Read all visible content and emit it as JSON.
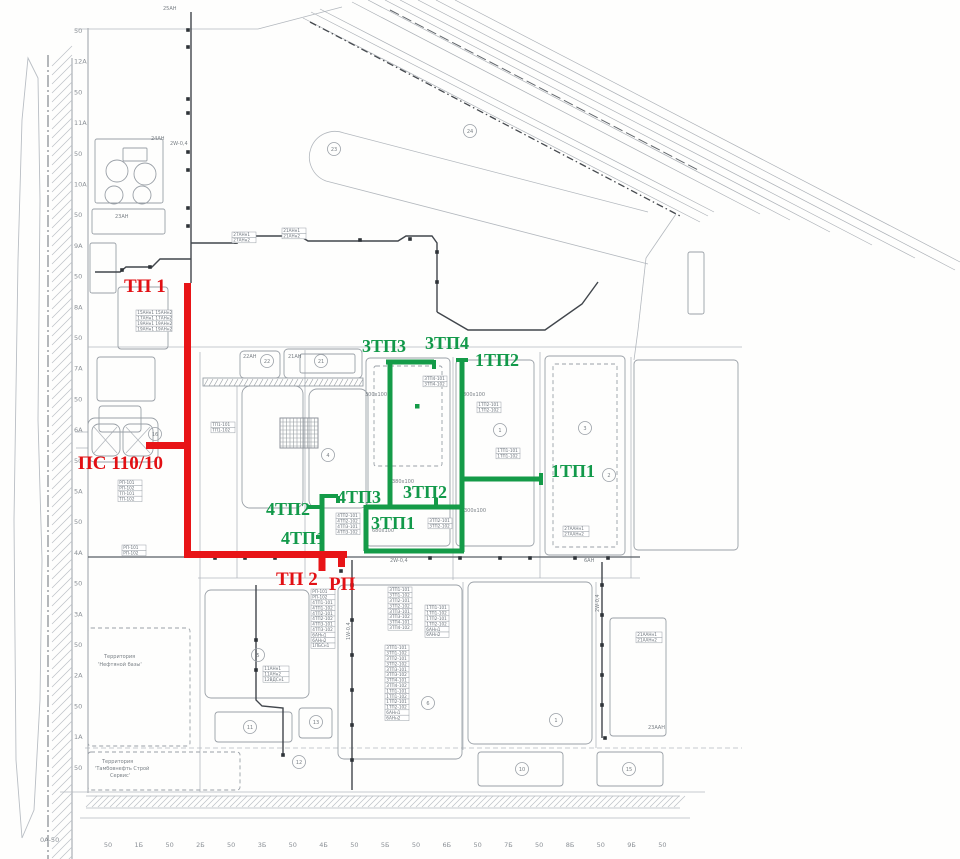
{
  "red_network": {
    "color": "#e81417",
    "labels": [
      {
        "text": "ТП 1"
      },
      {
        "text": "ПС 110/10"
      },
      {
        "text": "ТП 2"
      },
      {
        "text": "РП"
      }
    ]
  },
  "green_network": {
    "color": "#149b48",
    "labels": [
      {
        "text": "3ТП3"
      },
      {
        "text": "3ТП4"
      },
      {
        "text": "1ТП2"
      },
      {
        "text": "1ТП1"
      },
      {
        "text": "3ТП2"
      },
      {
        "text": "3ТП1"
      },
      {
        "text": "4ТП3"
      },
      {
        "text": "4ТП2"
      },
      {
        "text": "4ТП1"
      }
    ]
  },
  "axes": {
    "left": [
      "50",
      "12А",
      "50",
      "11А",
      "50",
      "10А",
      "50",
      "9А",
      "50",
      "8А",
      "50",
      "7А",
      "50",
      "6А",
      "50",
      "5А",
      "50",
      "4А",
      "50",
      "3А",
      "50",
      "2А",
      "50",
      "1А",
      "50"
    ],
    "origin": "0А-50",
    "bottom": [
      "50",
      "1Б",
      "50",
      "2Б",
      "50",
      "3Б",
      "50",
      "4Б",
      "50",
      "5Б",
      "50",
      "6Б",
      "50",
      "7Б",
      "50",
      "8Б",
      "50",
      "9Б",
      "50"
    ]
  },
  "annotations": {
    "boxes": [
      {
        "x": 311,
        "y": 589,
        "w": 24,
        "rows": [
          "РП-101",
          "РП-102",
          "4ТП1-101",
          "4ТП1-102",
          "4ТП2-101",
          "4ТП2-102",
          "4ТП3-101",
          "4ТП3-102",
          "6АНн1",
          "6АНн2",
          "1ПБСн1"
        ]
      },
      {
        "x": 388,
        "y": 587,
        "w": 24,
        "rows": [
          "3ТП1-101",
          "3ТП1-102",
          "3ТП2-101",
          "3ТП2-102",
          "3ТП3-101",
          "3ТП3-102",
          "3ТП4-101",
          "3ТП4-102"
        ]
      },
      {
        "x": 425,
        "y": 605,
        "w": 24,
        "rows": [
          "1ТП1-101",
          "1ТП1-102",
          "1ТП2-101",
          "1ТП2-102",
          "6АНн1",
          "6АНн2"
        ]
      },
      {
        "x": 385,
        "y": 645,
        "w": 24,
        "rows": [
          "3ТП1-101",
          "3ТП1-102",
          "3ТП2-101",
          "3ТП2-102",
          "3ТП3-101",
          "3ТП3-102",
          "3ТП4-101",
          "3ТП4-102",
          "1ТП1-101",
          "1ТП1-102",
          "1ТП2-101",
          "1ТП2-102",
          "6АНн1",
          "6АНн2"
        ]
      },
      {
        "x": 118,
        "y": 480,
        "w": 24,
        "rows": [
          "РП-101",
          "РП-102",
          "ТП-101",
          "ТП-102"
        ]
      },
      {
        "x": 122,
        "y": 545,
        "w": 24,
        "rows": [
          "РП-101",
          "РП-102"
        ]
      },
      {
        "x": 136,
        "y": 310,
        "w": 36,
        "rows": [
          "15АНн1 15АНн2",
          "17АНн1 17АНн2",
          "19АНн1 19АНн2",
          "19АНн1 19АНн2"
        ]
      },
      {
        "x": 211,
        "y": 422,
        "w": 24,
        "rows": [
          "ТП1-101",
          "ТП1-102"
        ]
      },
      {
        "x": 477,
        "y": 402,
        "w": 24,
        "rows": [
          "1ТП2-101",
          "1ТП2-102"
        ]
      },
      {
        "x": 423,
        "y": 376,
        "w": 24,
        "rows": [
          "3ТП4-101",
          "3ТП4-102"
        ]
      },
      {
        "x": 496,
        "y": 448,
        "w": 24,
        "rows": [
          "1ТП1-101",
          "1ТП1-102"
        ]
      },
      {
        "x": 428,
        "y": 518,
        "w": 24,
        "rows": [
          "3ТП2-101",
          "3ТП2-102"
        ]
      },
      {
        "x": 336,
        "y": 513,
        "w": 24,
        "rows": [
          "4ТП2-101",
          "4ТП2-102",
          "4ТП3-101",
          "4ТП3-102"
        ]
      },
      {
        "x": 563,
        "y": 526,
        "w": 26,
        "rows": [
          "27ААНн1",
          "27ААНн2"
        ]
      },
      {
        "x": 636,
        "y": 632,
        "w": 26,
        "rows": [
          "21ААНн1",
          "21ААНн2"
        ]
      },
      {
        "x": 263,
        "y": 666,
        "w": 26,
        "rows": [
          "11АНн1",
          "11АНн2",
          "12ВДСн1"
        ]
      },
      {
        "x": 282,
        "y": 228,
        "w": 24,
        "rows": [
          "21АНн1",
          "21АНн2"
        ]
      },
      {
        "x": 232,
        "y": 232,
        "w": 24,
        "rows": [
          "27АНн1",
          "27АНн2"
        ]
      }
    ],
    "labels": [
      {
        "t": "25АН",
        "x": 163,
        "y": 10
      },
      {
        "t": "24АН",
        "x": 151,
        "y": 140
      },
      {
        "t": "2W-0,4",
        "x": 170,
        "y": 145
      },
      {
        "t": "23АН",
        "x": 115,
        "y": 218
      },
      {
        "t": "22АН",
        "x": 243,
        "y": 358
      },
      {
        "t": "21АН",
        "x": 288,
        "y": 358
      },
      {
        "t": "300х100",
        "x": 365,
        "y": 396
      },
      {
        "t": "300х100",
        "x": 463,
        "y": 396
      },
      {
        "t": "380х100",
        "x": 392,
        "y": 483
      },
      {
        "t": "300х100",
        "x": 464,
        "y": 512
      },
      {
        "t": "680х100",
        "x": 372,
        "y": 532
      },
      {
        "t": "2W-0,4",
        "x": 390,
        "y": 562
      },
      {
        "t": "6АН",
        "x": 584,
        "y": 562
      },
      {
        "t": "23ААН",
        "x": 648,
        "y": 729
      },
      {
        "t": "1W-0,4",
        "x": 350,
        "y": 640,
        "rot": -90
      },
      {
        "t": "2W-0,4",
        "x": 599,
        "y": 612,
        "rot": -90
      },
      {
        "t": "Территория",
        "x": 104,
        "y": 658
      },
      {
        "t": "'Нефтяной базы'",
        "x": 98,
        "y": 666
      },
      {
        "t": "Территория",
        "x": 102,
        "y": 763
      },
      {
        "t": "'Тамбовнефть Строй",
        "x": 95,
        "y": 770
      },
      {
        "t": "Сервис'",
        "x": 110,
        "y": 777
      }
    ]
  },
  "base": {
    "buildings": [
      {
        "x": 95,
        "y": 139,
        "w": 68,
        "h": 64,
        "rx": 2
      },
      {
        "x": 123,
        "y": 148,
        "w": 24,
        "h": 13,
        "rx": 1
      },
      {
        "x": 92,
        "y": 209,
        "w": 73,
        "h": 25,
        "rx": 2
      },
      {
        "x": 90,
        "y": 243,
        "w": 26,
        "h": 50,
        "rx": 2
      },
      {
        "x": 118,
        "y": 287,
        "w": 50,
        "h": 62,
        "rx": 3
      },
      {
        "x": 97,
        "y": 357,
        "w": 58,
        "h": 44,
        "rx": 3
      },
      {
        "x": 99,
        "y": 406,
        "w": 42,
        "h": 26,
        "rx": 3
      },
      {
        "x": 88,
        "y": 418,
        "w": 70,
        "h": 44,
        "rx": 7
      },
      {
        "x": 92,
        "y": 424,
        "w": 28,
        "h": 32,
        "rx": 7
      },
      {
        "x": 123,
        "y": 424,
        "w": 30,
        "h": 32,
        "rx": 7
      },
      {
        "x": 240,
        "y": 351,
        "w": 40,
        "h": 27,
        "rx": 4
      },
      {
        "x": 284,
        "y": 349,
        "w": 78,
        "h": 29,
        "rx": 4
      },
      {
        "x": 300,
        "y": 354,
        "w": 55,
        "h": 19,
        "rx": 2
      },
      {
        "x": 242,
        "y": 386,
        "w": 61,
        "h": 122,
        "rx": 8
      },
      {
        "x": 309,
        "y": 389,
        "w": 59,
        "h": 119,
        "rx": 8
      },
      {
        "x": 366,
        "y": 358,
        "w": 84,
        "h": 188,
        "rx": 4
      },
      {
        "x": 374,
        "y": 366,
        "w": 68,
        "h": 100,
        "rx": 2,
        "dash": true
      },
      {
        "x": 456,
        "y": 360,
        "w": 78,
        "h": 186,
        "rx": 4
      },
      {
        "x": 545,
        "y": 356,
        "w": 80,
        "h": 199,
        "rx": 4
      },
      {
        "x": 553,
        "y": 364,
        "w": 64,
        "h": 183,
        "rx": 2,
        "dash": true
      },
      {
        "x": 634,
        "y": 360,
        "w": 104,
        "h": 190,
        "rx": 4
      },
      {
        "x": 205,
        "y": 590,
        "w": 104,
        "h": 108,
        "rx": 6
      },
      {
        "x": 215,
        "y": 712,
        "w": 77,
        "h": 30,
        "rx": 3
      },
      {
        "x": 299,
        "y": 708,
        "w": 33,
        "h": 30,
        "rx": 3
      },
      {
        "x": 338,
        "y": 585,
        "w": 124,
        "h": 174,
        "rx": 6
      },
      {
        "x": 468,
        "y": 582,
        "w": 124,
        "h": 162,
        "rx": 6
      },
      {
        "x": 478,
        "y": 752,
        "w": 85,
        "h": 34,
        "rx": 3
      },
      {
        "x": 597,
        "y": 752,
        "w": 66,
        "h": 34,
        "rx": 3
      },
      {
        "x": 610,
        "y": 618,
        "w": 56,
        "h": 118,
        "rx": 3
      },
      {
        "x": 688,
        "y": 252,
        "w": 16,
        "h": 62,
        "rx": 2
      },
      {
        "x": 88,
        "y": 628,
        "w": 102,
        "h": 118,
        "rx": 3,
        "dash": true
      },
      {
        "x": 88,
        "y": 752,
        "w": 152,
        "h": 38,
        "rx": 3,
        "dash": true
      },
      {
        "x": 203,
        "y": 378,
        "w": 160,
        "h": 8,
        "rx": 0
      }
    ],
    "grid": {
      "x": 280,
      "y": 418,
      "w": 38,
      "h": 30
    },
    "tanks": [
      [
        117,
        171,
        11
      ],
      [
        145,
        174,
        11
      ],
      [
        114,
        195,
        9
      ],
      [
        142,
        195,
        9
      ]
    ],
    "circle_marks": [
      {
        "n": "22",
        "x": 267,
        "y": 361
      },
      {
        "n": "21",
        "x": 321,
        "y": 361
      },
      {
        "n": "23",
        "x": 334,
        "y": 149
      },
      {
        "n": "24",
        "x": 470,
        "y": 131
      },
      {
        "n": "16",
        "x": 155,
        "y": 434
      },
      {
        "n": "4",
        "x": 328,
        "y": 455
      },
      {
        "n": "1",
        "x": 500,
        "y": 430
      },
      {
        "n": "3",
        "x": 585,
        "y": 428
      },
      {
        "n": "2",
        "x": 609,
        "y": 475
      },
      {
        "n": "5",
        "x": 258,
        "y": 655
      },
      {
        "n": "6",
        "x": 428,
        "y": 703
      },
      {
        "n": "11",
        "x": 250,
        "y": 727
      },
      {
        "n": "13",
        "x": 316,
        "y": 722
      },
      {
        "n": "12",
        "x": 299,
        "y": 762
      },
      {
        "n": "1",
        "x": 556,
        "y": 720
      },
      {
        "n": "10",
        "x": 522,
        "y": 769
      },
      {
        "n": "15",
        "x": 629,
        "y": 769
      }
    ],
    "roads": [
      [
        88,
        347,
        742,
        347
      ],
      [
        200,
        352,
        200,
        792
      ],
      [
        237,
        386,
        237,
        578
      ],
      [
        305,
        350,
        305,
        578
      ],
      [
        453,
        357,
        453,
        580
      ],
      [
        540,
        352,
        540,
        578
      ],
      [
        631,
        357,
        631,
        578
      ],
      [
        198,
        578,
        640,
        578
      ],
      [
        88,
        557,
        640,
        557,
        "dk"
      ],
      [
        463,
        582,
        463,
        750
      ],
      [
        596,
        582,
        596,
        748
      ],
      [
        85,
        748,
        742,
        748,
        "dsh"
      ],
      [
        60,
        792,
        705,
        792
      ],
      [
        86,
        796,
        680,
        796
      ],
      [
        86,
        808,
        680,
        808
      ],
      [
        80,
        818,
        690,
        818
      ],
      [
        75,
        29,
        258,
        29
      ],
      [
        258,
        29,
        342,
        7
      ],
      [
        676,
        214,
        646,
        258
      ],
      [
        646,
        258,
        638,
        330
      ],
      [
        638,
        330,
        634,
        360
      ],
      [
        94,
        427,
        117,
        453
      ],
      [
        117,
        427,
        94,
        453
      ],
      [
        126,
        427,
        150,
        453
      ],
      [
        150,
        427,
        126,
        453
      ],
      [
        75,
        432,
        88,
        432
      ],
      [
        76,
        448,
        88,
        448
      ]
    ],
    "racks": [
      "191,12 191,283",
      "95,272 120,272 126,267 152,267 160,259 191,259",
      "191,243 236,243 248,236 300,236 308,241 398,241 406,236 432,236 437,243 437,312",
      "437,312 468,330 545,330 582,304 598,282",
      "352,560 352,790",
      "602,562 602,738",
      "256,585 256,700 262,706 283,708 283,755"
    ],
    "squares": [
      [
        188,
        30
      ],
      [
        188,
        47
      ],
      [
        188,
        99
      ],
      [
        188,
        113
      ],
      [
        188,
        152
      ],
      [
        188,
        170
      ],
      [
        188,
        208
      ],
      [
        188,
        226
      ],
      [
        150,
        267
      ],
      [
        122,
        270
      ],
      [
        236,
        242
      ],
      [
        300,
        237
      ],
      [
        360,
        240
      ],
      [
        410,
        239
      ],
      [
        437,
        252
      ],
      [
        437,
        282
      ],
      [
        352,
        585
      ],
      [
        352,
        620
      ],
      [
        352,
        655
      ],
      [
        352,
        690
      ],
      [
        352,
        725
      ],
      [
        352,
        760
      ],
      [
        602,
        585
      ],
      [
        602,
        615
      ],
      [
        602,
        645
      ],
      [
        602,
        675
      ],
      [
        602,
        705
      ],
      [
        605,
        738
      ],
      [
        283,
        755
      ],
      [
        256,
        640
      ],
      [
        256,
        670
      ],
      [
        215,
        558
      ],
      [
        245,
        558
      ],
      [
        275,
        558
      ],
      [
        430,
        558
      ],
      [
        460,
        558
      ],
      [
        500,
        558
      ],
      [
        530,
        558
      ],
      [
        575,
        558
      ],
      [
        608,
        558
      ],
      [
        341,
        571
      ]
    ],
    "rail": [
      [
        303,
        18,
        700,
        222
      ],
      [
        311,
        12,
        708,
        216
      ],
      [
        320,
        9,
        714,
        212
      ],
      [
        310,
        22,
        682,
        217,
        "dk"
      ],
      [
        390,
        10,
        700,
        171,
        "dk2"
      ],
      [
        352,
        2,
        760,
        214
      ],
      [
        368,
        0,
        790,
        220
      ],
      [
        385,
        0,
        830,
        232
      ],
      [
        400,
        0,
        872,
        245
      ],
      [
        418,
        0,
        915,
        258
      ],
      [
        436,
        0,
        955,
        270
      ],
      [
        455,
        0,
        960,
        262
      ]
    ]
  }
}
